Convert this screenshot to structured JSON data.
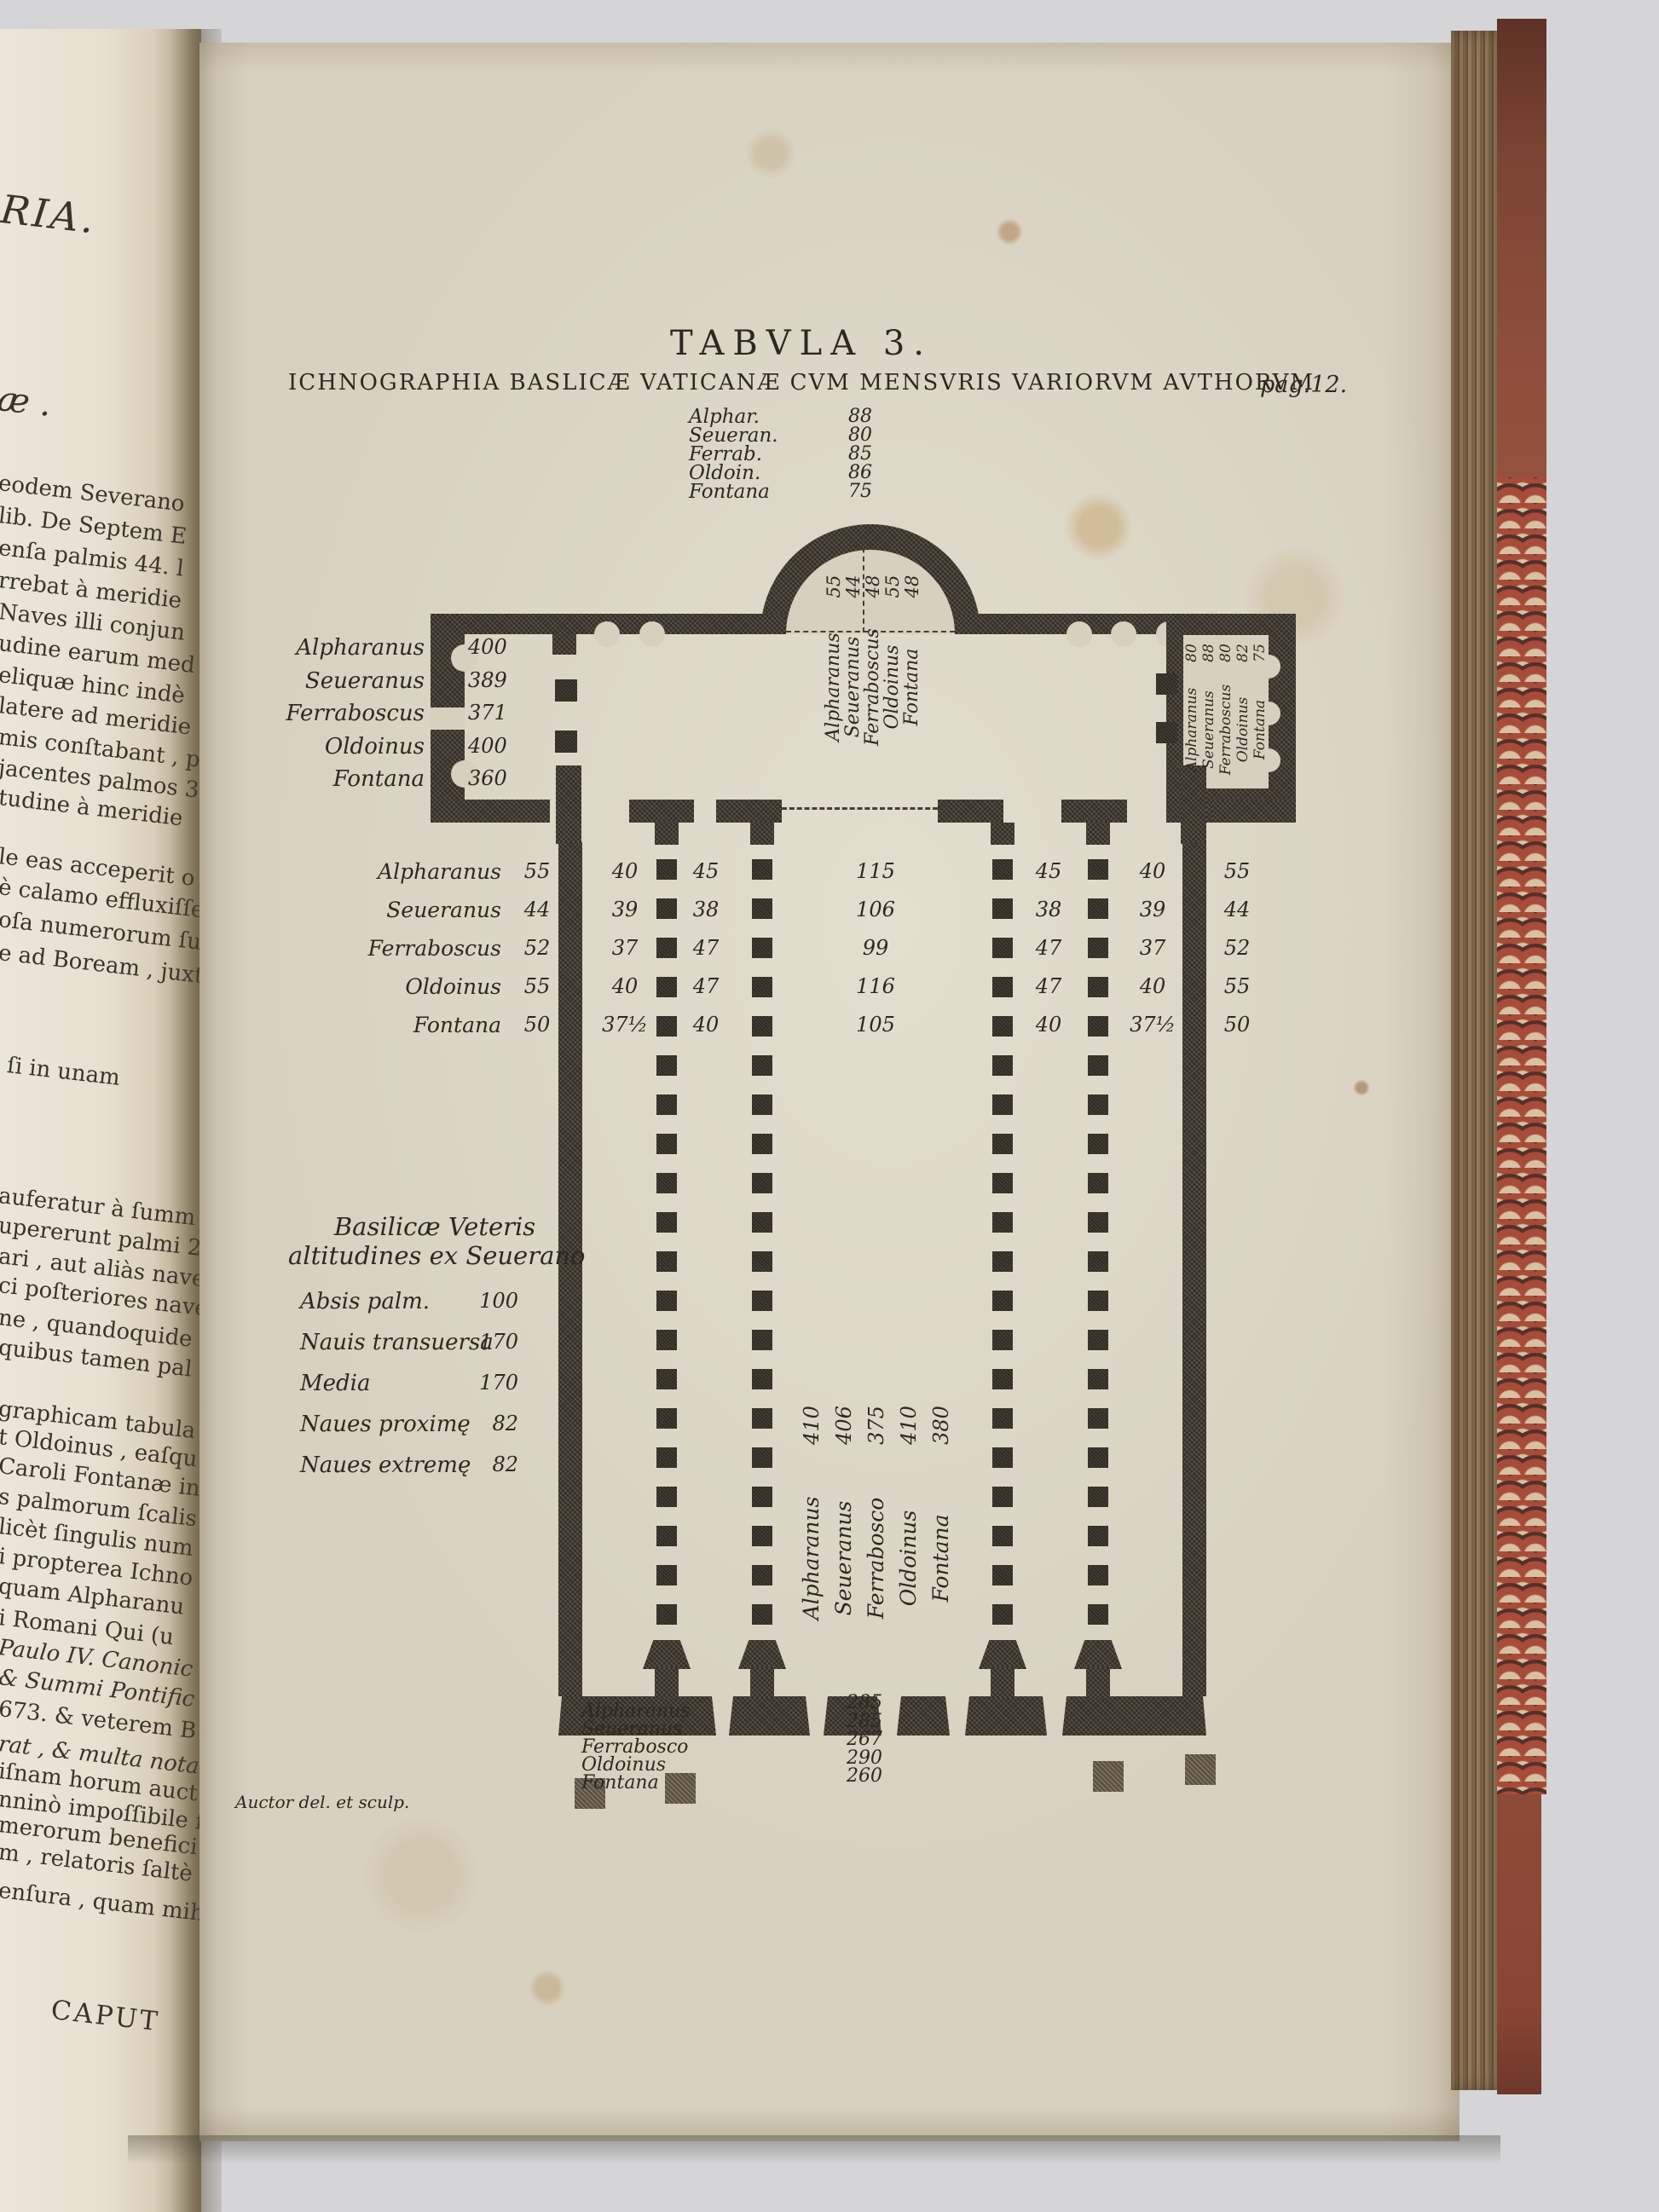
{
  "plate": {
    "heading": "TABVLA 3.",
    "page_ref": "pag.12.",
    "title": "ICHNOGRAPHIA BASLICÆ VATICANÆ CVM MENSVRIS VARIORVM AVTHORVM",
    "credit": "Auctor del. et sculp.",
    "apse_width_table": [
      [
        "Alphar.",
        "88"
      ],
      [
        "Seueran.",
        "80"
      ],
      [
        "Ferrab.",
        "85"
      ],
      [
        "Oldoin.",
        "86"
      ],
      [
        "Fontana",
        "75"
      ]
    ],
    "apse_interior": {
      "values": [
        "55",
        "44",
        "48",
        "55",
        "48"
      ],
      "names": [
        "Alpharanus",
        "Seueranus",
        "Ferraboscus",
        "Oldoinus",
        "Fontana"
      ]
    },
    "transept_left": {
      "names": [
        "Alpharanus",
        "Seueranus",
        "Ferraboscus",
        "Oldoinus",
        "Fontana"
      ],
      "values": [
        "400",
        "389",
        "371",
        "400",
        "360"
      ]
    },
    "transept_right": {
      "names": [
        "Alpharanus",
        "Seueranus",
        "Ferraboscus",
        "Oldoinus",
        "Fontana"
      ],
      "values": [
        "80",
        "88",
        "80",
        "82",
        "75"
      ]
    },
    "nave_width_rows": [
      {
        "name": "Alpharanus",
        "values": [
          "55",
          "40",
          "45",
          "115",
          "45",
          "40",
          "55"
        ]
      },
      {
        "name": "Seueranus",
        "values": [
          "44",
          "39",
          "38",
          "106",
          "38",
          "39",
          "44"
        ]
      },
      {
        "name": "Ferraboscus",
        "values": [
          "52",
          "37",
          "47",
          "99",
          "47",
          "37",
          "52"
        ]
      },
      {
        "name": "Oldoinus",
        "values": [
          "55",
          "40",
          "47",
          "116",
          "47",
          "40",
          "55"
        ]
      },
      {
        "name": "Fontana",
        "values": [
          "50",
          "37½",
          "40",
          "105",
          "40",
          "37½",
          "50"
        ]
      }
    ],
    "altitudes": {
      "title1": "Basilicæ Veteris",
      "title2": "altitudines ex Seuerano",
      "rows": [
        [
          "Absis palm.",
          "100"
        ],
        [
          "Nauis transuersa",
          "170"
        ],
        [
          "Media",
          "170"
        ],
        [
          "Naues proximę",
          "82"
        ],
        [
          "Naues extremę",
          "82"
        ]
      ]
    },
    "nave_length": {
      "values": [
        "410",
        "406",
        "375",
        "410",
        "380"
      ],
      "names": [
        "Alpharanus",
        "Seueranus",
        "Ferrabosco",
        "Oldoinus",
        "Fontana"
      ]
    },
    "facade": {
      "names": [
        "Alpharanus",
        "Seueranus",
        "Ferrabosco",
        "Oldoinus",
        "Fontana"
      ],
      "values": [
        "285",
        "285",
        "267",
        "290",
        "260"
      ]
    }
  },
  "left_page": {
    "fragments": [
      "RIA.",
      "æ .",
      "eodem Severano",
      "lib. De Septem E",
      "enſa palmis 44. l",
      "rrebat à meridie",
      "Naves illi conjun",
      "udine earum med",
      "eliquæ hinc indè",
      "latere ad meridie",
      "mis conſtabant , p",
      "jacentes palmos 3",
      "tudine à meridie",
      "le eas acceperit o",
      "è calamo effluxiſſe",
      "oſa numerorum ſup",
      "e ad Boream , juxt",
      "ſi in unam",
      "auferatur à ſumm",
      "upererunt palmi 2",
      "ari , aut aliàs nave",
      "ci poſteriores nave",
      "ne , quandoquide",
      "quibus tamen pal",
      "graphicam tabula",
      "t Oldoinus , eaſqu",
      "Caroli Fontanæ in",
      "s palmorum ſcalis",
      "licèt ſingulis num",
      "i propterea Ichno",
      "quam Alpharanu",
      "i Romani Qui (u",
      "Paulo IV. Canonic",
      "& Summi Pontific",
      "673. & veterem B",
      "rat , & multa nota",
      "iſnam horum auct",
      "nninò impoſſibile f",
      "merorum benefici",
      "m , relatoris ſaltè",
      "enſura , quam mih",
      "CAPUT"
    ]
  },
  "colors": {
    "table_background": "#d5d5d8",
    "plate_paper": "#d8d1c0",
    "facing_paper": "#ece6d8",
    "ink": "#2e2820",
    "fore_edge": "#7a6349",
    "cover_red": "#8d4e3b",
    "marble_cream": "#d7c1a2"
  }
}
